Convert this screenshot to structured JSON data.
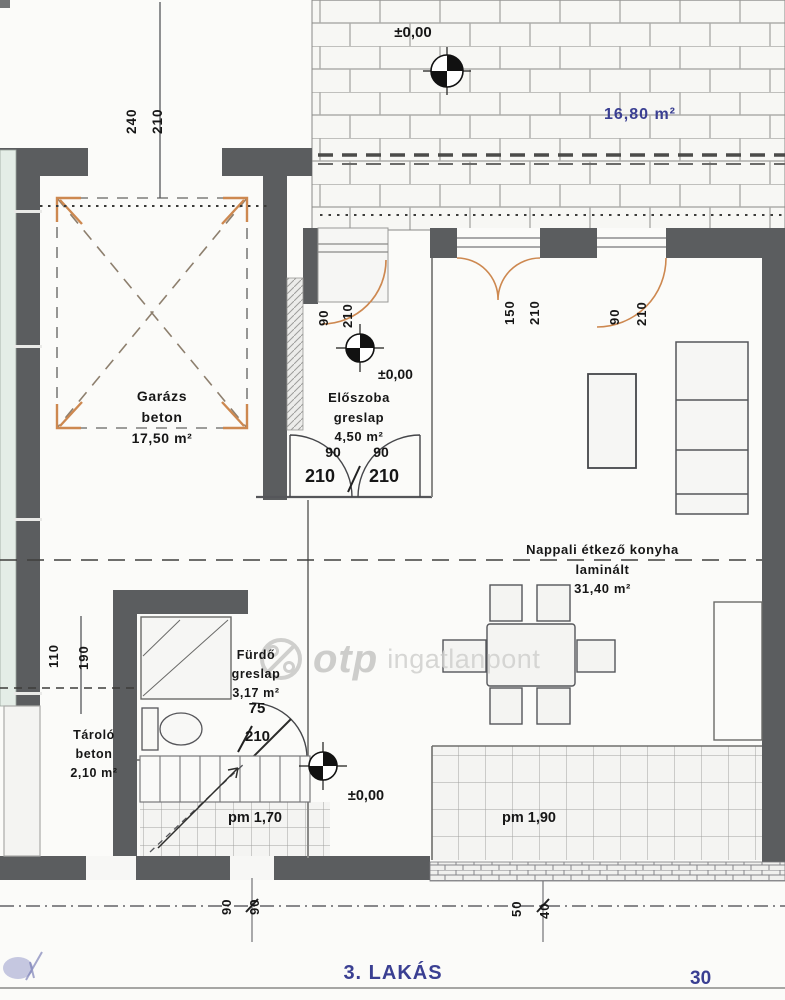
{
  "meta": {
    "plan_title": "3. LAKÁS",
    "corner_note": "30"
  },
  "watermark": {
    "brand": "otp",
    "suffix": "ingatlanpont"
  },
  "annotations": {
    "elevation_top": "±0,00",
    "elevation_entry": "±0,00",
    "elevation_bottom": "±0,00",
    "pm_stairs": "pm 1,70",
    "pm_terrace": "pm 1,90"
  },
  "rooms": {
    "terrace": {
      "area": "16,80 m²"
    },
    "garage": {
      "name": "Garázs",
      "floor": "beton",
      "area": "17,50 m²"
    },
    "eloszoba": {
      "name": "Előszoba",
      "floor": "greslap",
      "area": "4,50 m²"
    },
    "nappali": {
      "name": "Nappali étkező konyha",
      "floor": "laminált",
      "area": "31,40 m²"
    },
    "furdo": {
      "name": "Fürdő",
      "floor": "greslap",
      "area": "3,17 m²"
    },
    "tarolo": {
      "name": "Tároló",
      "floor": "beton",
      "area": "2,10 m²"
    }
  },
  "dimensions": {
    "garage_door": {
      "w": "240",
      "h": "210"
    },
    "entry_door": {
      "w": "90",
      "h": "210"
    },
    "window_living": {
      "w": "150",
      "h": "210"
    },
    "door_terrace": {
      "w": "90",
      "h": "210"
    },
    "double_door_left": {
      "w": "90",
      "h": "210"
    },
    "double_door_right": {
      "w": "90",
      "h": "210"
    },
    "storage_width": "110",
    "storage_length": "190",
    "bath_door": {
      "w": "75",
      "h": "210"
    },
    "bottom_left_a": "90",
    "bottom_left_b": "90",
    "bottom_right_a": "50",
    "bottom_right_b": "40"
  }
}
